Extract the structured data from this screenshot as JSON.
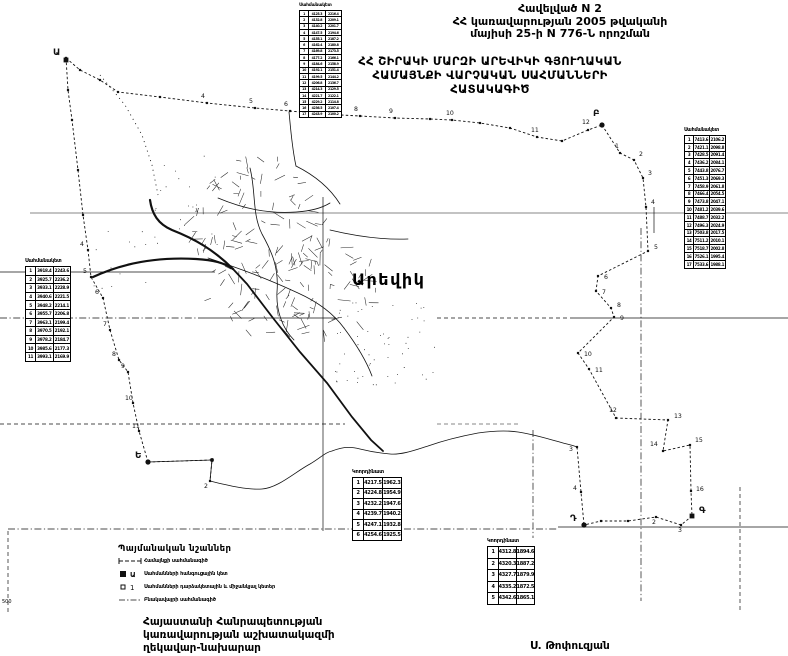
{
  "page": {
    "appendix": [
      "Հավելված N 2",
      "ՀՀ կառավարության 2005 թվականի",
      "մայիսի 25-ի N 776-Ն որոշման"
    ],
    "title": [
      "ՀՀ ՇԻՐԱԿԻ ՄԱՐԶԻ ԱՐԵՎԻԿԻ ԳՅՈՒՂԱԿԱՆ",
      "ՀԱՄԱՅՆՔԻ  ՎԱՐՉԱԿԱՆ  ՍԱՀՄԱՆՆԵՐԻ",
      "ՀԱՏԱԿԱԳԻԾ"
    ],
    "footer": [
      "Հայաստանի Հանրապետության",
      "կառավարության աշխատակազմի",
      "ղեկավար-նախարար"
    ],
    "signature": "Ս. Թոփուզյան",
    "scale_note": "500",
    "ink_color": "#111111",
    "paper_color": "#ffffff"
  },
  "legend": {
    "title": "Պայմանական նշաններ",
    "items": [
      {
        "symbol": "community-boundary-line",
        "label": "Համայնքի սահմանագիծ"
      },
      {
        "symbol": "junction-point",
        "label": "Սահմանների հանգուցային կետ"
      },
      {
        "symbol": "turning-point",
        "label": "Սահմանների դարձակետային և միջանկյալ կետեր"
      },
      {
        "symbol": "settlement-boundary-line",
        "label": "Բնակավայրի սահմանագիծ"
      }
    ]
  },
  "map": {
    "label": "Արեվիկ",
    "junctions": [
      {
        "t": "Ա",
        "x": 66,
        "y": 60,
        "lx": 53,
        "ly": 55,
        "shape": "sq"
      },
      {
        "t": "Բ",
        "x": 602,
        "y": 125,
        "lx": 593,
        "ly": 116,
        "shape": "c"
      },
      {
        "t": "Գ",
        "x": 692,
        "y": 516,
        "lx": 699,
        "ly": 513,
        "shape": "sq"
      },
      {
        "t": "Դ",
        "x": 584,
        "y": 525,
        "lx": 570,
        "ly": 521,
        "shape": "c"
      },
      {
        "t": "Ե",
        "x": 148,
        "y": 462,
        "lx": 135,
        "ly": 458,
        "shape": "c"
      }
    ],
    "grid": {
      "h": [
        {
          "y": 213,
          "x1": 30,
          "x2": 788,
          "s": "solid",
          "w": 0.6
        },
        {
          "y": 272,
          "x1": 0,
          "x2": 215,
          "s": "solid",
          "w": 0.7
        },
        {
          "y": 318,
          "x1": 0,
          "x2": 205,
          "s": "dashdot",
          "w": 0.7
        },
        {
          "y": 318,
          "x1": 205,
          "x2": 336,
          "s": "solid",
          "w": 0.8
        },
        {
          "y": 318,
          "x1": 437,
          "x2": 573,
          "s": "dash",
          "w": 0.7
        },
        {
          "y": 318,
          "x1": 573,
          "x2": 788,
          "s": "solid",
          "w": 0.8
        },
        {
          "y": 424,
          "x1": 0,
          "x2": 345,
          "s": "dash",
          "w": 0.7
        },
        {
          "y": 424,
          "x1": 437,
          "x2": 520,
          "s": "dash",
          "w": 0.6
        },
        {
          "y": 529,
          "x1": 8,
          "x2": 558,
          "s": "dashdot",
          "w": 0.7
        },
        {
          "y": 527,
          "x1": 558,
          "x2": 788,
          "s": "solid",
          "w": 0.8
        }
      ],
      "v": [
        {
          "x": 8,
          "y1": 531,
          "y2": 612,
          "s": "dash",
          "w": 0.7
        },
        {
          "x": 323,
          "y1": 197,
          "y2": 531,
          "s": "solid",
          "w": 0.7
        },
        {
          "x": 533,
          "y1": 430,
          "y2": 577,
          "s": "dashdot",
          "w": 0.7
        },
        {
          "x": 641,
          "y1": 228,
          "y2": 601,
          "s": "dashdot",
          "w": 0.7
        },
        {
          "x": 654,
          "y1": 207,
          "y2": 233,
          "s": "solid",
          "w": 0.7
        },
        {
          "x": 740,
          "y1": 487,
          "y2": 612,
          "s": "dash",
          "w": 0.7
        }
      ]
    },
    "segments": [
      {
        "name": "north-boundary",
        "pts": [
          [
            66,
            58
          ],
          [
            80,
            70
          ],
          [
            100,
            80
          ],
          [
            118,
            92
          ],
          [
            160,
            97
          ],
          [
            207,
            103
          ],
          [
            255,
            108
          ],
          [
            290,
            111
          ],
          [
            322,
            114
          ],
          [
            360,
            116
          ],
          [
            395,
            118
          ],
          [
            430,
            119
          ],
          [
            452,
            120
          ],
          [
            480,
            123
          ],
          [
            510,
            128
          ],
          [
            537,
            137
          ],
          [
            562,
            141
          ],
          [
            588,
            130
          ],
          [
            602,
            125
          ]
        ],
        "labels": [
          {
            "t": "4",
            "x": 201,
            "y": 98
          },
          {
            "t": "5",
            "x": 249,
            "y": 103
          },
          {
            "t": "6",
            "x": 284,
            "y": 106
          },
          {
            "t": "7",
            "x": 316,
            "y": 109
          },
          {
            "t": "8",
            "x": 354,
            "y": 111
          },
          {
            "t": "9",
            "x": 389,
            "y": 113
          },
          {
            "t": "10",
            "x": 446,
            "y": 115
          },
          {
            "t": "11",
            "x": 531,
            "y": 132
          },
          {
            "t": "12",
            "x": 582,
            "y": 124
          }
        ]
      },
      {
        "name": "east-boundary",
        "pts": [
          [
            602,
            125
          ],
          [
            620,
            153
          ],
          [
            634,
            160
          ],
          [
            643,
            178
          ],
          [
            646,
            207
          ],
          [
            648,
            251
          ],
          [
            598,
            276
          ],
          [
            596,
            291
          ],
          [
            611,
            308
          ],
          [
            614,
            317
          ],
          [
            578,
            353
          ],
          [
            589,
            369
          ],
          [
            616,
            418
          ],
          [
            668,
            420
          ],
          [
            663,
            451
          ],
          [
            690,
            445
          ],
          [
            691,
            491
          ],
          [
            692,
            516
          ]
        ],
        "labels": [
          {
            "t": "1",
            "x": 615,
            "y": 148
          },
          {
            "t": "2",
            "x": 639,
            "y": 156
          },
          {
            "t": "3",
            "x": 648,
            "y": 175
          },
          {
            "t": "4",
            "x": 651,
            "y": 204
          },
          {
            "t": "5",
            "x": 654,
            "y": 249
          },
          {
            "t": "6",
            "x": 604,
            "y": 279
          },
          {
            "t": "7",
            "x": 602,
            "y": 294
          },
          {
            "t": "8",
            "x": 617,
            "y": 307
          },
          {
            "t": "9",
            "x": 620,
            "y": 320
          },
          {
            "t": "10",
            "x": 584,
            "y": 356
          },
          {
            "t": "11",
            "x": 595,
            "y": 372
          },
          {
            "t": "12",
            "x": 609,
            "y": 412
          },
          {
            "t": "13",
            "x": 674,
            "y": 418
          },
          {
            "t": "14",
            "x": 650,
            "y": 446
          },
          {
            "t": "15",
            "x": 695,
            "y": 442
          },
          {
            "t": "16",
            "x": 696,
            "y": 491
          }
        ]
      },
      {
        "name": "south-boundary",
        "pts": [
          [
            692,
            516
          ],
          [
            681,
            525
          ],
          [
            656,
            517
          ],
          [
            628,
            521
          ],
          [
            601,
            521
          ],
          [
            584,
            525
          ]
        ],
        "labels": [
          {
            "t": "3",
            "x": 678,
            "y": 532
          },
          {
            "t": "2",
            "x": 652,
            "y": 524
          }
        ]
      },
      {
        "name": "southwest-boundary",
        "pts": [
          [
            577,
            447
          ],
          [
            581,
            492
          ],
          [
            584,
            525
          ]
        ],
        "labels": [
          {
            "t": "3",
            "x": 569,
            "y": 451
          },
          {
            "t": "4",
            "x": 573,
            "y": 490
          }
        ]
      },
      {
        "name": "west-link",
        "pts": [
          [
            148,
            462
          ],
          [
            212,
            460
          ],
          [
            210,
            481
          ]
        ],
        "labels": [
          {
            "t": "2",
            "x": 204,
            "y": 488
          }
        ]
      },
      {
        "name": "west-boundary",
        "pts": [
          [
            148,
            462
          ],
          [
            139,
            431
          ],
          [
            133,
            403
          ],
          [
            128,
            372
          ],
          [
            119,
            360
          ],
          [
            110,
            330
          ],
          [
            103,
            298
          ],
          [
            91,
            277
          ],
          [
            88,
            250
          ],
          [
            83,
            215
          ],
          [
            78,
            170
          ],
          [
            72,
            120
          ],
          [
            68,
            90
          ],
          [
            66,
            58
          ]
        ],
        "labels": [
          {
            "t": "11",
            "x": 132,
            "y": 428
          },
          {
            "t": "10",
            "x": 125,
            "y": 400
          },
          {
            "t": "9",
            "x": 121,
            "y": 368
          },
          {
            "t": "8",
            "x": 112,
            "y": 356
          },
          {
            "t": "7",
            "x": 103,
            "y": 326
          },
          {
            "t": "6",
            "x": 95,
            "y": 294
          },
          {
            "t": "5",
            "x": 83,
            "y": 273
          },
          {
            "t": "4",
            "x": 80,
            "y": 246
          }
        ]
      }
    ],
    "river": "M148,462 L212,460 L210,481 C230,486 248,490 262,489 C278,488 295,472 310,464 C320,458 326,452 332,451 C345,446 352,447 360,449 C372,452 378,453 390,454 C402,455 415,450 428,446 C445,440 462,436 478,433 C492,431 505,430 518,432 C532,434 545,438 556,441 C566,444 572,445 577,447",
    "roads": [
      {
        "d": "M93,277 C125,262 160,257 196,259 C214,260 224,263 233,269",
        "w": 2.2
      },
      {
        "d": "M150,200 C152,214 158,224 172,230 C195,239 214,250 233,269",
        "w": 2.2
      },
      {
        "d": "M233,269 L247,284 L273,318 L300,352 L327,383 L352,417 L371,440 L383,451",
        "w": 1.8
      },
      {
        "d": "M289,112 C291,132 292,148 296,166",
        "w": 0.8
      },
      {
        "d": "M250,168 C256,192 252,214 262,234 C272,252 279,268 277,292 C276,310 282,328 294,340",
        "w": 0.8
      },
      {
        "d": "M218,198 C242,208 266,214 296,212 C312,211 322,208 330,203",
        "w": 0.8
      },
      {
        "d": "M208,258 C238,268 266,278 298,293 C318,302 333,313 344,328",
        "w": 0.8
      },
      {
        "d": "M330,230 C355,236 382,240 408,239",
        "w": 0.8
      },
      {
        "d": "M296,166 C316,176 330,188 340,204",
        "w": 0.8
      },
      {
        "d": "M344,328 C356,344 366,360 372,376",
        "w": 0.8
      }
    ],
    "track": {
      "d": "M100,75 L125,105 L142,135 L152,165 L158,195",
      "dash": "1,4"
    },
    "village": {
      "clusters": [
        {
          "cx": 262,
          "cy": 242,
          "rx": 72,
          "ry": 92,
          "n": 120
        },
        {
          "cx": 330,
          "cy": 285,
          "rx": 48,
          "ry": 58,
          "n": 55
        }
      ],
      "stipple": [
        {
          "x": 335,
          "y": 300,
          "w": 100,
          "h": 85,
          "n": 60
        },
        {
          "x": 150,
          "y": 140,
          "w": 70,
          "h": 110,
          "n": 22
        },
        {
          "x": 90,
          "y": 210,
          "w": 60,
          "h": 80,
          "n": 12
        }
      ]
    }
  },
  "tables": [
    {
      "header": "Սահմանակետ",
      "x": 299,
      "y": 3,
      "w": 43,
      "rowH": 5.3,
      "fs": 3.2,
      "hfs": 4.5,
      "cols": [
        9,
        17,
        17
      ],
      "rows": [
        [
          "1",
          "4125.3",
          "2216.4"
        ],
        [
          "2",
          "4132.8",
          "2209.1"
        ],
        [
          "3",
          "4140.2",
          "2201.7"
        ],
        [
          "4",
          "4147.5",
          "2194.6"
        ],
        [
          "5",
          "4155.1",
          "2187.2"
        ],
        [
          "6",
          "4162.4",
          "2180.8"
        ],
        [
          "7",
          "4169.8",
          "2173.5"
        ],
        [
          "8",
          "4177.2",
          "2166.1"
        ],
        [
          "9",
          "4184.6",
          "2158.9"
        ],
        [
          "10",
          "4192.1",
          "2151.4"
        ],
        [
          "11",
          "4199.5",
          "2144.2"
        ],
        [
          "12",
          "4206.8",
          "2136.7"
        ],
        [
          "13",
          "4214.3",
          "2129.5"
        ],
        [
          "14",
          "4221.7",
          "2122.1"
        ],
        [
          "15",
          "4229.2",
          "2114.8"
        ],
        [
          "16",
          "4236.5",
          "2107.4"
        ],
        [
          "17",
          "4243.9",
          "2100.2"
        ]
      ]
    },
    {
      "header": "Սահմանակետ",
      "x": 684,
      "y": 128,
      "w": 42,
      "rowH": 6.8,
      "fs": 4,
      "hfs": 4.8,
      "cols": [
        9,
        16,
        17
      ],
      "rows": [
        [
          "1",
          "7413.6",
          "2106.2"
        ],
        [
          "2",
          "7421.1",
          "2098.8"
        ],
        [
          "3",
          "7428.5",
          "2091.4"
        ],
        [
          "4",
          "7436.2",
          "2084.1"
        ],
        [
          "5",
          "7443.8",
          "2076.7"
        ],
        [
          "6",
          "7451.3",
          "2069.3"
        ],
        [
          "7",
          "7458.9",
          "2061.8"
        ],
        [
          "8",
          "7466.4",
          "2054.5"
        ],
        [
          "9",
          "7473.8",
          "2047.1"
        ],
        [
          "10",
          "7481.2",
          "2039.6"
        ],
        [
          "11",
          "7488.7",
          "2032.2"
        ],
        [
          "12",
          "7496.3",
          "2024.9"
        ],
        [
          "13",
          "7503.8",
          "2017.5"
        ],
        [
          "14",
          "7511.2",
          "2010.1"
        ],
        [
          "15",
          "7518.7",
          "2002.8"
        ],
        [
          "16",
          "7526.1",
          "1995.4"
        ],
        [
          "17",
          "7533.6",
          "1988.1"
        ]
      ]
    },
    {
      "header": "Սահմանակետ",
      "x": 25,
      "y": 258,
      "w": 46,
      "rowH": 7.6,
      "fs": 4.2,
      "hfs": 5,
      "cols": [
        10,
        18,
        18
      ],
      "rows": [
        [
          "1",
          "3918.4",
          "2243.6"
        ],
        [
          "2",
          "3925.7",
          "2236.2"
        ],
        [
          "3",
          "3933.1",
          "2228.9"
        ],
        [
          "4",
          "3940.6",
          "2221.5"
        ],
        [
          "5",
          "3948.2",
          "2214.1"
        ],
        [
          "6",
          "3955.7",
          "2206.8"
        ],
        [
          "7",
          "3963.1",
          "2199.4"
        ],
        [
          "8",
          "3970.5",
          "2192.1"
        ],
        [
          "9",
          "3978.2",
          "2184.7"
        ],
        [
          "10",
          "3985.6",
          "2177.3"
        ],
        [
          "11",
          "3993.1",
          "2169.9"
        ]
      ]
    },
    {
      "header": "Կոորդինատ",
      "x": 352,
      "y": 469,
      "w": 50,
      "rowH": 9.5,
      "fs": 5,
      "hfs": 5.2,
      "cols": [
        11,
        19,
        20
      ],
      "rows": [
        [
          "1",
          "4217.5",
          "1962.3"
        ],
        [
          "2",
          "4224.8",
          "1954.9"
        ],
        [
          "3",
          "4232.2",
          "1947.6"
        ],
        [
          "4",
          "4239.7",
          "1940.2"
        ],
        [
          "5",
          "4247.1",
          "1932.8"
        ],
        [
          "6",
          "4254.6",
          "1925.5"
        ]
      ]
    },
    {
      "header": "Կոորդինատ",
      "x": 487,
      "y": 538,
      "w": 48,
      "rowH": 10.5,
      "fs": 5,
      "hfs": 5.2,
      "cols": [
        11,
        18,
        19
      ],
      "rows": [
        [
          "1",
          "4312.8",
          "1894.6"
        ],
        [
          "2",
          "4320.3",
          "1887.2"
        ],
        [
          "3",
          "4327.7",
          "1879.9"
        ],
        [
          "4",
          "4335.2",
          "1872.5"
        ],
        [
          "5",
          "4342.6",
          "1865.1"
        ]
      ]
    }
  ]
}
